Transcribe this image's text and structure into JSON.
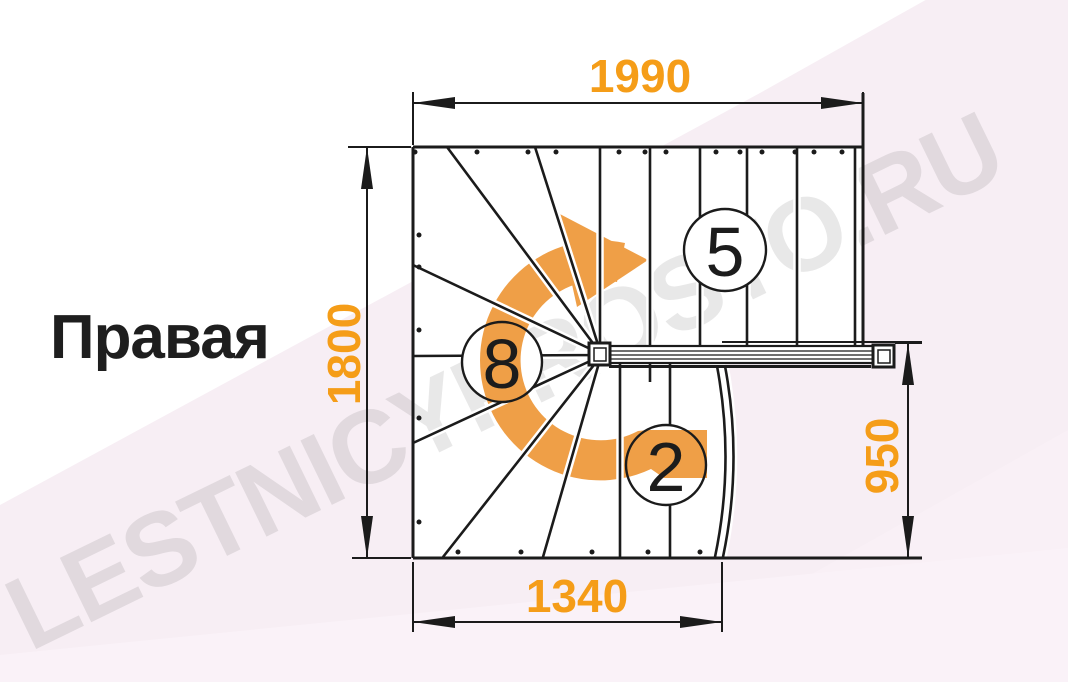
{
  "title": {
    "label": "Правая"
  },
  "watermark": {
    "text": "LESTNICYPROSTO.RU"
  },
  "dimensions": {
    "width_top": "1990",
    "height_left": "1800",
    "width_bottom": "1340",
    "height_right": "950",
    "units": "mm"
  },
  "steps": {
    "upper_flight": "5",
    "winder": "8",
    "lower_flight": "2"
  },
  "icons": {
    "rotation_arrow": "clockwise-turn-arrow"
  },
  "colors": {
    "dimension_orange": "#F59D18",
    "arrow_orange": "#EF9F47",
    "drawing_black": "#1B1B1B",
    "background_pink": "#F7EEF4",
    "background_pink_light": "#FAF2F8",
    "stair_fill": "#FFFFFF",
    "watermark_gray": "#6F6F6F"
  }
}
